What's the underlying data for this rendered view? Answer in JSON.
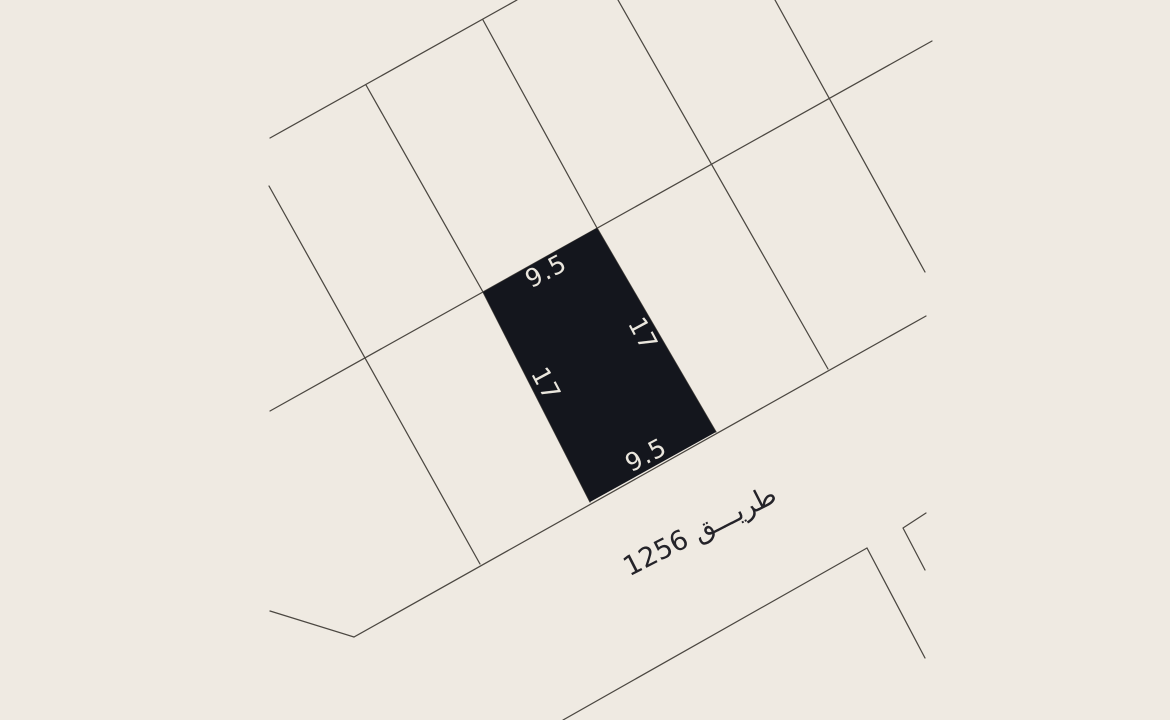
{
  "map": {
    "background_color": "#efeae2",
    "line_color": "#4b4741",
    "parcel": {
      "fill": "#14161d",
      "label_color": "#eae6dd",
      "dimensions": {
        "top": "9.5",
        "right": "17",
        "left": "17",
        "bottom": "9.5"
      }
    },
    "road": {
      "label": "طريق 1256",
      "display_label": "طريـــق 1256",
      "text_color": "#242329"
    }
  }
}
